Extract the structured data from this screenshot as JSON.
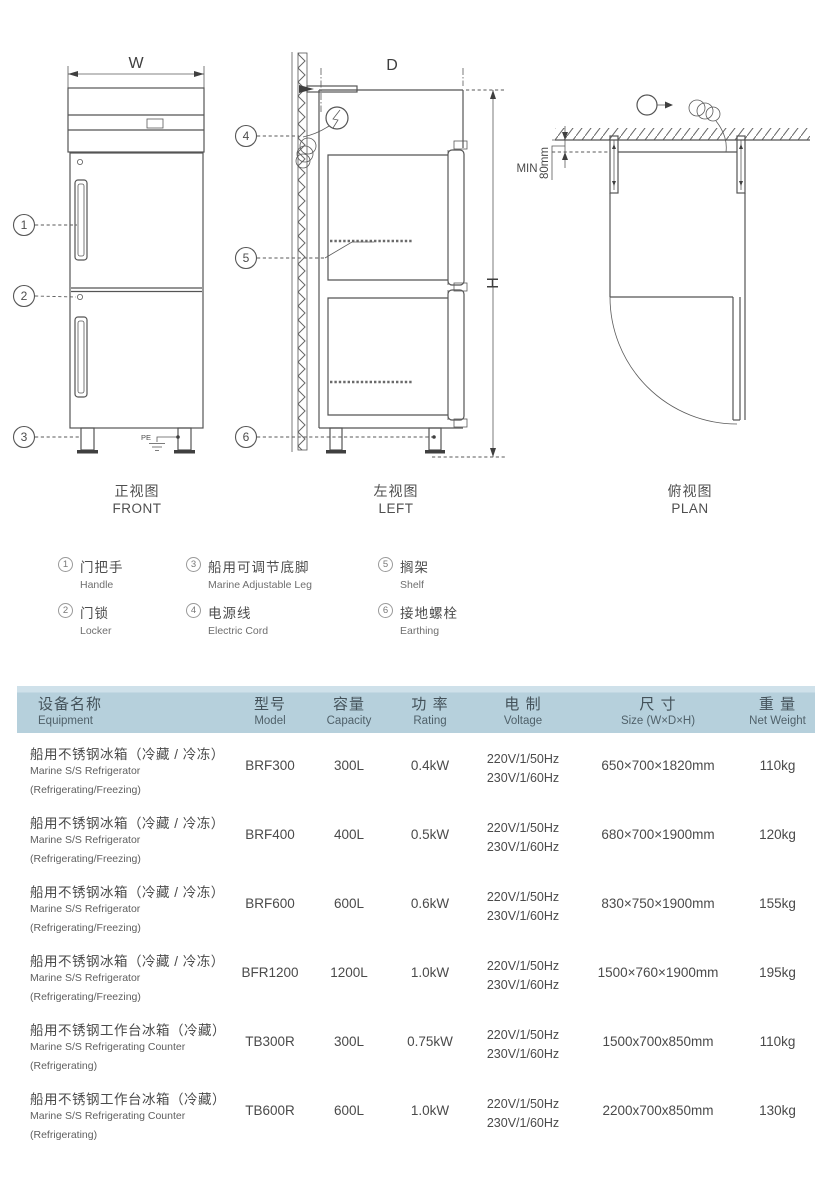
{
  "doc": {
    "views": {
      "front": {
        "caption_zh": "正视图",
        "caption_en": "FRONT",
        "dim_width_label": "W",
        "pe_label": "PE"
      },
      "left": {
        "caption_zh": "左视图",
        "caption_en": "LEFT",
        "dim_depth_label": "D",
        "dim_height_label": "H"
      },
      "plan": {
        "caption_zh": "俯视图",
        "caption_en": "PLAN",
        "min_label": "MIN",
        "clearance_label": "80mm"
      }
    },
    "callout_numbers": [
      "1",
      "2",
      "3",
      "4",
      "5",
      "6"
    ]
  },
  "legend": {
    "items": [
      {
        "num": "1",
        "zh": "门把手",
        "en": "Handle"
      },
      {
        "num": "2",
        "zh": "门锁",
        "en": "Locker"
      },
      {
        "num": "3",
        "zh": "船用可调节底脚",
        "en": "Marine Adjustable Leg"
      },
      {
        "num": "4",
        "zh": "电源线",
        "en": "Electric Cord"
      },
      {
        "num": "5",
        "zh": "搁架",
        "en": "Shelf"
      },
      {
        "num": "6",
        "zh": "接地螺栓",
        "en": "Earthing"
      }
    ]
  },
  "table": {
    "header": {
      "equipment_zh": "设备名称",
      "equipment_en": "Equipment",
      "model_zh": "型号",
      "model_en": "Model",
      "capacity_zh": "容量",
      "capacity_en": "Capacity",
      "rating_zh": "功 率",
      "rating_en": "Rating",
      "voltage_zh": "电 制",
      "voltage_en": "Voltage",
      "size_zh": "尺 寸",
      "size_en": "Size (W×D×H)",
      "weight_zh": "重 量",
      "weight_en": "Net Weight"
    },
    "rows": [
      {
        "name_zh": "船用不锈钢冰箱（冷藏 / 冷冻）",
        "name_en": "Marine S/S Refrigerator",
        "name_sub": "(Refrigerating/Freezing)",
        "model": "BRF300",
        "capacity": "300L",
        "rating": "0.4kW",
        "voltage1": "220V/1/50Hz",
        "voltage2": "230V/1/60Hz",
        "size": "650×700×1820mm",
        "weight": "110kg"
      },
      {
        "name_zh": "船用不锈钢冰箱（冷藏 / 冷冻）",
        "name_en": "Marine S/S Refrigerator",
        "name_sub": "(Refrigerating/Freezing)",
        "model": "BRF400",
        "capacity": "400L",
        "rating": "0.5kW",
        "voltage1": "220V/1/50Hz",
        "voltage2": "230V/1/60Hz",
        "size": "680×700×1900mm",
        "weight": "120kg"
      },
      {
        "name_zh": "船用不锈钢冰箱（冷藏 / 冷冻）",
        "name_en": "Marine S/S Refrigerator",
        "name_sub": "(Refrigerating/Freezing)",
        "model": "BRF600",
        "capacity": "600L",
        "rating": "0.6kW",
        "voltage1": "220V/1/50Hz",
        "voltage2": "230V/1/60Hz",
        "size": "830×750×1900mm",
        "weight": "155kg"
      },
      {
        "name_zh": "船用不锈钢冰箱（冷藏 / 冷冻）",
        "name_en": "Marine S/S Refrigerator",
        "name_sub": "(Refrigerating/Freezing)",
        "model": "BFR1200",
        "capacity": "1200L",
        "rating": "1.0kW",
        "voltage1": "220V/1/50Hz",
        "voltage2": "230V/1/60Hz",
        "size": "1500×760×1900mm",
        "weight": "195kg"
      },
      {
        "name_zh": "船用不锈钢工作台冰箱（冷藏）",
        "name_en": "Marine S/S Refrigerating Counter",
        "name_sub": "(Refrigerating)",
        "model": "TB300R",
        "capacity": "300L",
        "rating": "0.75kW",
        "voltage1": "220V/1/50Hz",
        "voltage2": "230V/1/60Hz",
        "size": "1500x700x850mm",
        "weight": "110kg"
      },
      {
        "name_zh": "船用不锈钢工作台冰箱（冷藏）",
        "name_en": "Marine S/S Refrigerating Counter",
        "name_sub": "(Refrigerating)",
        "model": "TB600R",
        "capacity": "600L",
        "rating": "1.0kW",
        "voltage1": "220V/1/50Hz",
        "voltage2": "230V/1/60Hz",
        "size": "2200x700x850mm",
        "weight": "130kg"
      }
    ]
  },
  "colors": {
    "header_band": "#b6d0dc",
    "header_band_light": "#cfe1ea",
    "line": "#555555",
    "text": "#474747"
  }
}
